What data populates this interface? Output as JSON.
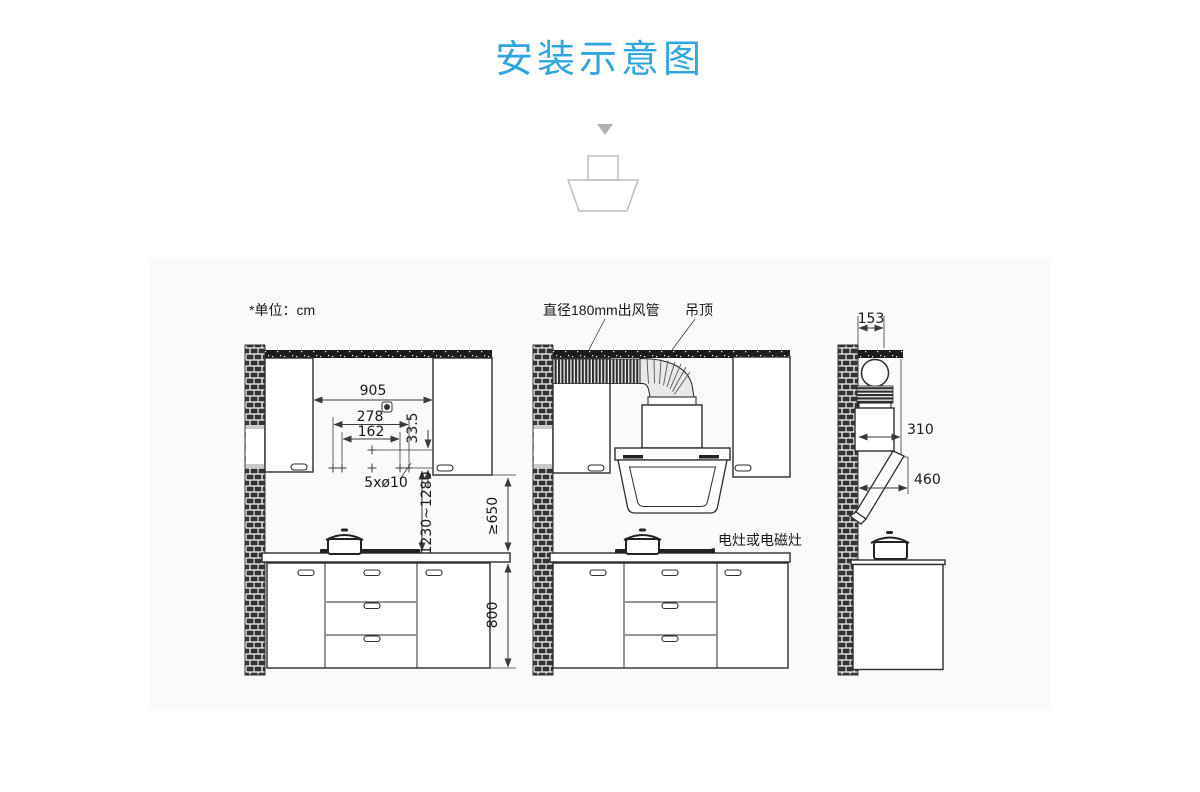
{
  "title": {
    "text": "安装示意图",
    "accent_color": "#2FA6E0"
  },
  "diagram": {
    "unit_note": "*单位：cm",
    "callouts": {
      "duct_pipe": "直径180mm出风管",
      "ceiling": "吊顶",
      "stove": "电灶或电磁灶"
    },
    "front_dims": {
      "cabinet_gap_width": "905",
      "outer_hole_span": "278",
      "inner_hole_span": "162",
      "hole_row_offset": "33.5",
      "mounting_holes": "5xø10",
      "install_height_range": "1230~1280",
      "min_hood_clearance": "≥650",
      "counter_height": "800"
    },
    "side_dims": {
      "top_depth": "153",
      "mid_depth": "310",
      "body_depth": "460"
    }
  }
}
